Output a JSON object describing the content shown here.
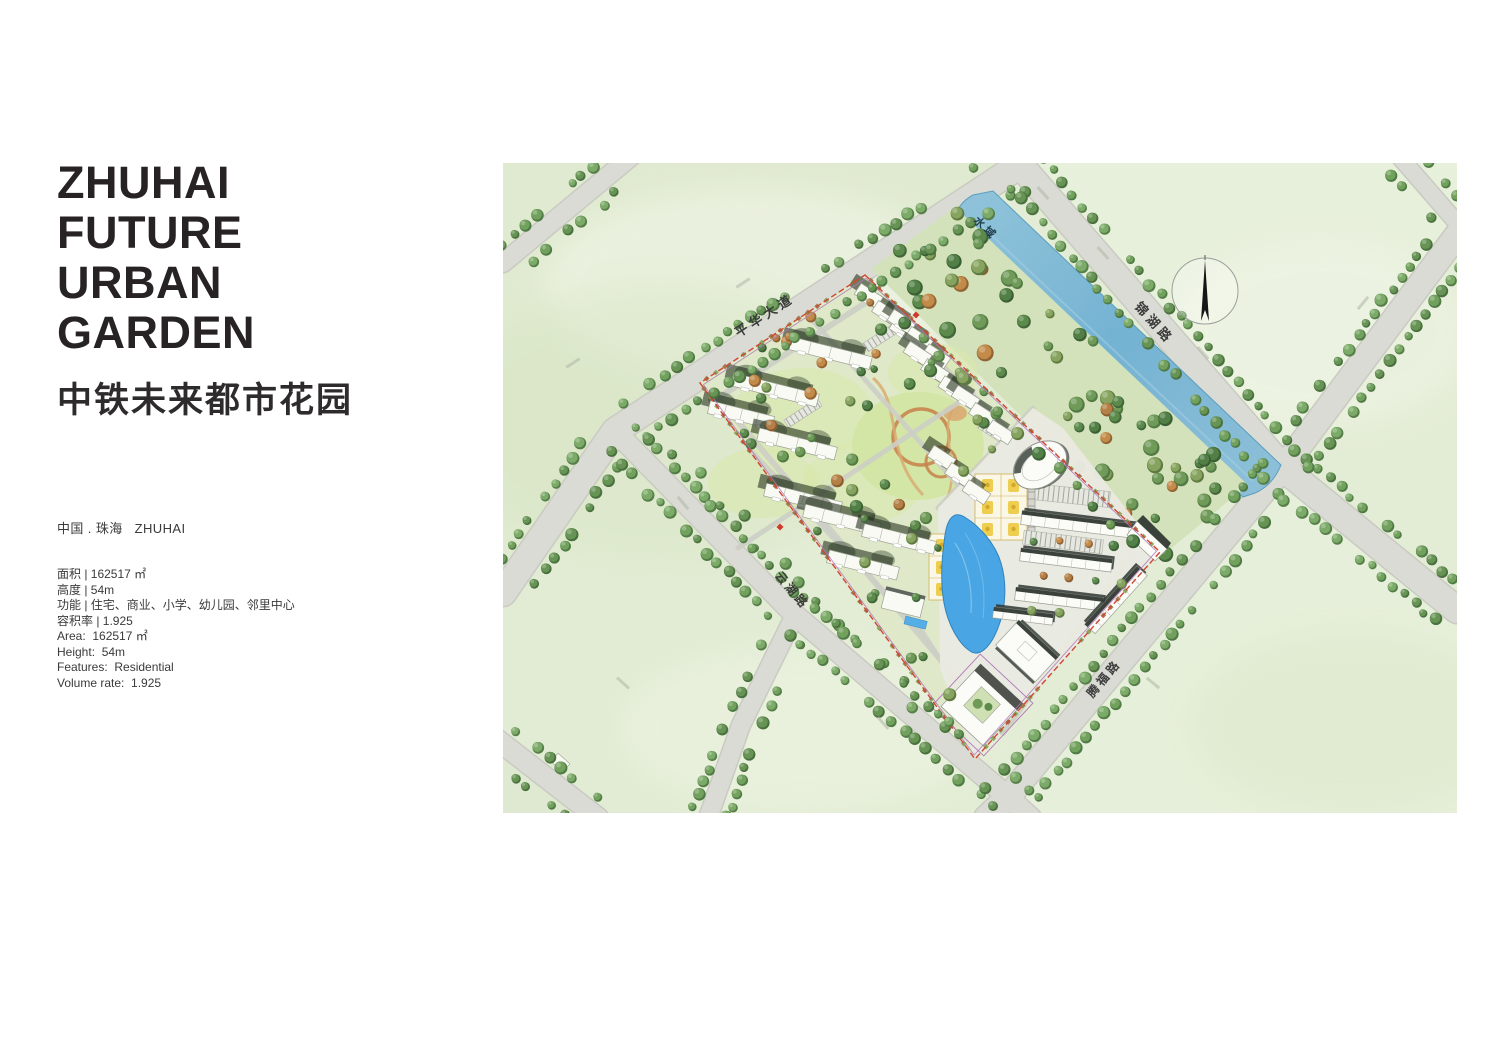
{
  "header": {
    "title_lines": [
      "ZHUHAI",
      "FUTURE",
      "URBAN",
      "GARDEN"
    ],
    "subtitle_cn": "中铁未来都市花园",
    "location": "中国 . 珠海   ZHUHAI"
  },
  "stats": {
    "rows": [
      "面积 | 162517 ㎡",
      "高度 | 54m",
      "功能 | 住宅、商业、小学、幼儿园、邻里中心",
      "容积率 | 1.925",
      "Area:  162517 ㎡",
      "Height:  54m",
      "Features:  Residential",
      "Volume rate:  1.925"
    ]
  },
  "map": {
    "road_labels": {
      "pinghua": "平华大道",
      "jinhu": "锦湖路",
      "yunhu": "云湖路",
      "tengfu": "腾福路"
    },
    "water_label": "水域",
    "colors": {
      "field": "#e3ecd5",
      "road": "#dadbd4",
      "road_edge": "#c9cbc2",
      "water": "#7db9d8",
      "water_deep": "#5da3c8",
      "pool": "#4aa5e4",
      "site_green": "#dfe9c9",
      "boundary_red": "#cf4631",
      "boundary_purple": "#b277b8",
      "tree_green": "#6b9b59",
      "track_orange": "#c8854f"
    }
  }
}
